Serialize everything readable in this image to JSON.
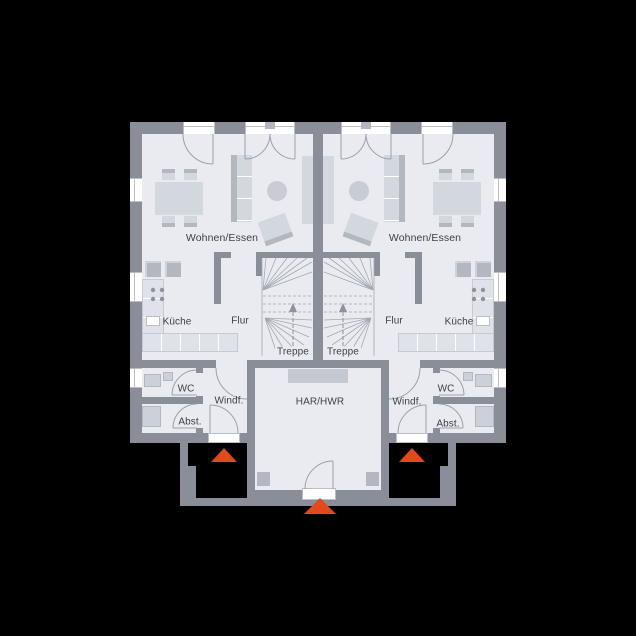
{
  "colors": {
    "background": "#000000",
    "floor": "#e9ebf1",
    "wall": "#8a8e99",
    "line": "#9aa0ab",
    "furniture": "#d3d7de",
    "furniture_dark": "#b3b7c0",
    "counter": "#dfe2e8",
    "window": "#ffffff",
    "accent": "#e2491c",
    "label": "#3d4048"
  },
  "units": {
    "left": {
      "living": "Wohnen/Essen",
      "kitchen": "Küche",
      "hall": "Flur",
      "stairs": "Treppe",
      "wc": "WC",
      "vestibule": "Windf.",
      "storage": "Abst."
    },
    "right": {
      "living": "Wohnen/Essen",
      "kitchen": "Küche",
      "hall": "Flur",
      "stairs": "Treppe",
      "wc": "WC",
      "vestibule": "Windf.",
      "storage": "Abst."
    }
  },
  "shared": {
    "utility": "HAR/HWR"
  },
  "icons": {
    "entrance_marker": "triangle-up"
  }
}
